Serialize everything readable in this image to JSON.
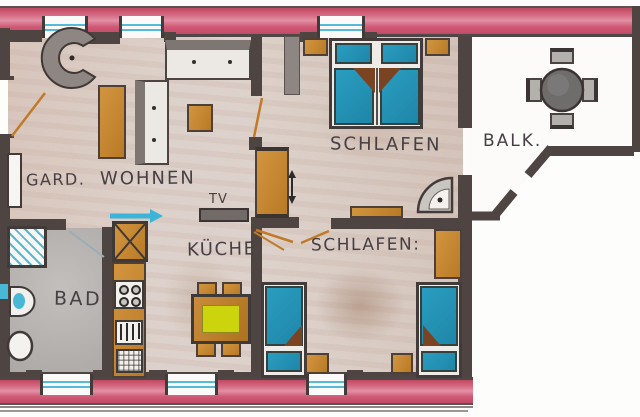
{
  "type": "hand-drawn apartment floorplan",
  "rooms": {
    "gard": {
      "label": "GARD."
    },
    "wohnen": {
      "label": "WOHNEN"
    },
    "schlafen1": {
      "label": "SCHLAFEN"
    },
    "balkon": {
      "label": "BALK."
    },
    "kueche": {
      "label": "KÜCHE"
    },
    "bad": {
      "label": "BAD"
    },
    "schlafen2": {
      "label": "SCHLAFEN:"
    }
  },
  "annotations": {
    "tv": {
      "label": "TV"
    }
  },
  "icons": {
    "entrance_arrow": "right-arrow",
    "passage_arrow": "up-down-arrow"
  },
  "colors": {
    "wall": "#4e4542",
    "wall_light": "#8d8682",
    "exterior_band_red": "#d25070",
    "floor_beige": "#dcd0c9",
    "bath_floor_gray": "#b6b2b0",
    "balcony_floor": "#fcfbfa",
    "furniture_orange": "#c6862f",
    "bed_blue": "#2492b4",
    "blanket_brown": "#7a4422",
    "table_yellow": "#ccd40e",
    "window_cyan": "#55bcd8",
    "arrow_cyan": "#3cb4d8",
    "text": "#463f43"
  }
}
